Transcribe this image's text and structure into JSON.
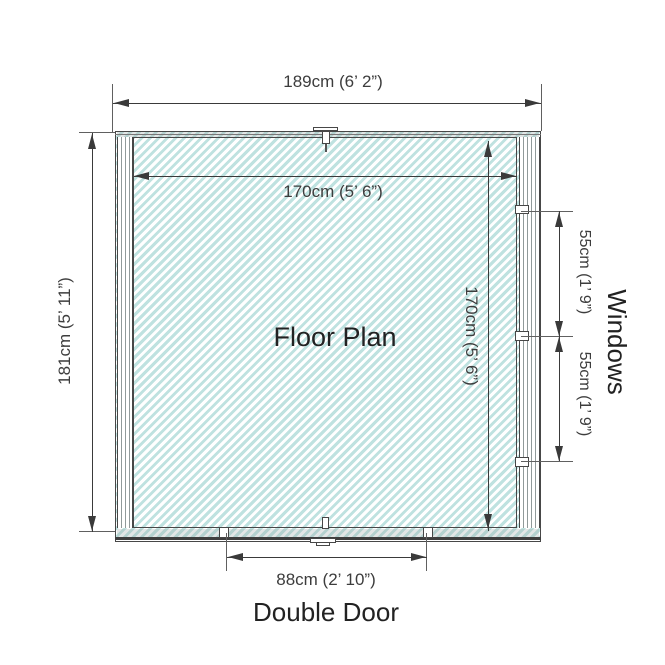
{
  "diagram": {
    "title": "Floor Plan",
    "side_label": "Windows",
    "bottom_label": "Double Door",
    "dims": {
      "overall_width": "189cm (6’ 2”)",
      "overall_height": "181cm (5’ 11”)",
      "interior_width": "170cm (5’ 6”)",
      "interior_height": "170cm (5’ 6”)",
      "window_upper": "55cm (1’ 9”)",
      "window_lower": "55cm (1’ 9”)",
      "door_width": "88cm (2’ 10”)"
    },
    "colors": {
      "hatch_line": "#bfe2e0",
      "wall_line": "#474747",
      "dim_line": "#3a3a3a",
      "ext_line": "#606060",
      "text": "#3d3d3d",
      "label_text": "#222222"
    }
  }
}
